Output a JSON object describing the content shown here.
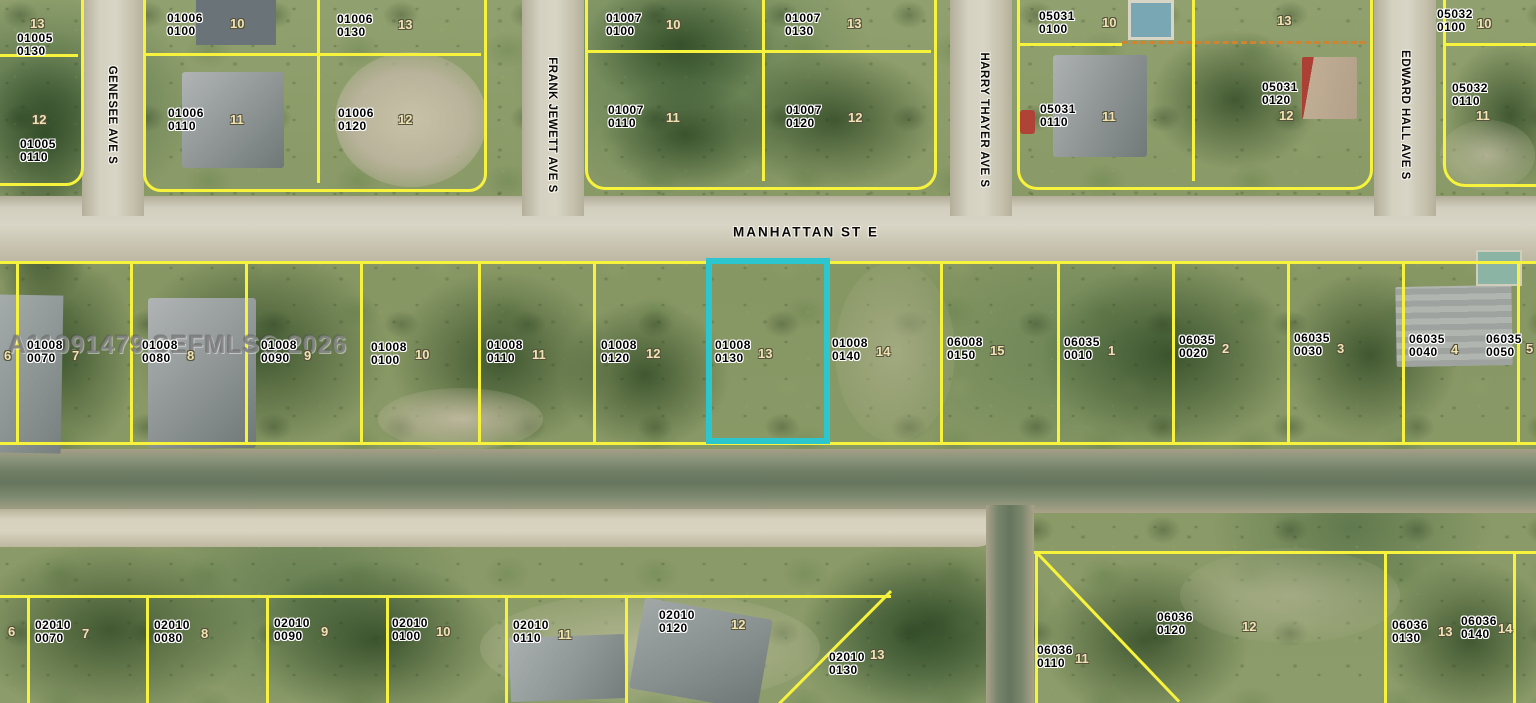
{
  "watermark": "A11091479 SEFMLS© 2026",
  "highlighted_parcel": {
    "book": "01008",
    "page": "0130",
    "lot": "13",
    "outline_color": "#2cc7ce"
  },
  "colors": {
    "parcel_line": "#f7f33d",
    "dashed_line": "#cd8531",
    "highlight": "#2cc7ce"
  },
  "streets": [
    {
      "name": "GENESEE AVE S",
      "orientation": "vertical",
      "x": 112,
      "y": 115
    },
    {
      "name": "FRANK JEWETT AVE S",
      "orientation": "vertical",
      "x": 552,
      "y": 125
    },
    {
      "name": "MANHATTAN ST E",
      "orientation": "horizontal",
      "x": 806,
      "y": 232
    },
    {
      "name": "HARRY THAYER AVE S",
      "orientation": "vertical",
      "x": 984,
      "y": 120
    },
    {
      "name": "EDWARD HALL AVE S",
      "orientation": "vertical",
      "x": 1405,
      "y": 115
    }
  ],
  "parcels": [
    {
      "book": "01005",
      "page": "0130",
      "lot": "13",
      "x": 17,
      "y": 32,
      "lx": 30,
      "ly": 16
    },
    {
      "book": "01005",
      "page": "0110",
      "lot": "12",
      "x": 20,
      "y": 138,
      "lx": 32,
      "ly": 112
    },
    {
      "book": "01006",
      "page": "0100",
      "lot": "10",
      "x": 167,
      "y": 12,
      "lx": 230,
      "ly": 16
    },
    {
      "book": "01006",
      "page": "0130",
      "lot": "13",
      "x": 337,
      "y": 13,
      "lx": 398,
      "ly": 17
    },
    {
      "book": "01006",
      "page": "0110",
      "lot": "11",
      "x": 168,
      "y": 107,
      "lx": 230,
      "ly": 112
    },
    {
      "book": "01006",
      "page": "0120",
      "lot": "12",
      "x": 338,
      "y": 107,
      "lx": 398,
      "ly": 112
    },
    {
      "book": "01007",
      "page": "0100",
      "lot": "10",
      "x": 606,
      "y": 12,
      "lx": 666,
      "ly": 17
    },
    {
      "book": "01007",
      "page": "0130",
      "lot": "13",
      "x": 785,
      "y": 12,
      "lx": 847,
      "ly": 16
    },
    {
      "book": "01007",
      "page": "0110",
      "lot": "11",
      "x": 608,
      "y": 104,
      "lx": 666,
      "ly": 110
    },
    {
      "book": "01007",
      "page": "0120",
      "lot": "12",
      "x": 786,
      "y": 104,
      "lx": 848,
      "ly": 110
    },
    {
      "book": "05031",
      "page": "0100",
      "lot": "10",
      "x": 1039,
      "y": 10,
      "lx": 1102,
      "ly": 15
    },
    {
      "lot": "13",
      "lx": 1277,
      "ly": 13
    },
    {
      "book": "05031",
      "page": "0120",
      "lot": "12",
      "x": 1262,
      "y": 81,
      "lx": 1279,
      "ly": 108
    },
    {
      "book": "05031",
      "page": "0110",
      "lot": "11",
      "x": 1040,
      "y": 103,
      "lx": 1102,
      "ly": 109
    },
    {
      "book": "05032",
      "page": "0100",
      "lot": "10",
      "x": 1437,
      "y": 8,
      "lx": 1477,
      "ly": 16
    },
    {
      "book": "05032",
      "page": "0110",
      "lot": "11",
      "x": 1452,
      "y": 82,
      "lx": 1476,
      "ly": 108
    },
    {
      "lot": "6",
      "lx": 4,
      "ly": 348
    },
    {
      "book": "01008",
      "page": "0070",
      "lot": "7",
      "x": 27,
      "y": 339,
      "lx": 72,
      "ly": 348
    },
    {
      "book": "01008",
      "page": "0080",
      "lot": "8",
      "x": 142,
      "y": 339,
      "lx": 187,
      "ly": 348
    },
    {
      "book": "01008",
      "page": "0090",
      "lot": "9",
      "x": 261,
      "y": 339,
      "lx": 304,
      "ly": 348
    },
    {
      "book": "01008",
      "page": "0100",
      "lot": "10",
      "x": 371,
      "y": 341,
      "lx": 415,
      "ly": 347
    },
    {
      "book": "01008",
      "page": "0110",
      "lot": "11",
      "x": 487,
      "y": 339,
      "lx": 532,
      "ly": 347
    },
    {
      "book": "01008",
      "page": "0120",
      "lot": "12",
      "x": 601,
      "y": 339,
      "lx": 646,
      "ly": 346
    },
    {
      "book": "01008",
      "page": "0130",
      "lot": "13",
      "x": 715,
      "y": 339,
      "lx": 758,
      "ly": 346
    },
    {
      "book": "01008",
      "page": "0140",
      "lot": "14",
      "x": 832,
      "y": 337,
      "lx": 876,
      "ly": 344
    },
    {
      "book": "06008",
      "page": "0150",
      "lot": "15",
      "x": 947,
      "y": 336,
      "lx": 990,
      "ly": 343
    },
    {
      "book": "06035",
      "page": "0010",
      "lot": "1",
      "x": 1064,
      "y": 336,
      "lx": 1108,
      "ly": 343
    },
    {
      "book": "06035",
      "page": "0020",
      "lot": "2",
      "x": 1179,
      "y": 334,
      "lx": 1222,
      "ly": 341
    },
    {
      "book": "06035",
      "page": "0030",
      "lot": "3",
      "x": 1294,
      "y": 332,
      "lx": 1337,
      "ly": 341
    },
    {
      "book": "06035",
      "page": "0040",
      "lot": "4",
      "x": 1409,
      "y": 333,
      "lx": 1451,
      "ly": 342
    },
    {
      "book": "06035",
      "page": "0050",
      "lot": "5",
      "x": 1486,
      "y": 333,
      "lx": 1526,
      "ly": 341
    },
    {
      "lot": "6",
      "lx": 8,
      "ly": 624
    },
    {
      "book": "02010",
      "page": "0070",
      "lot": "7",
      "x": 35,
      "y": 619,
      "lx": 82,
      "ly": 626
    },
    {
      "book": "02010",
      "page": "0080",
      "lot": "8",
      "x": 154,
      "y": 619,
      "lx": 201,
      "ly": 626
    },
    {
      "book": "02010",
      "page": "0090",
      "lot": "9",
      "x": 274,
      "y": 617,
      "lx": 321,
      "ly": 624
    },
    {
      "book": "02010",
      "page": "0100",
      "lot": "10",
      "x": 392,
      "y": 617,
      "lx": 436,
      "ly": 624
    },
    {
      "book": "02010",
      "page": "0110",
      "lot": "11",
      "x": 513,
      "y": 619,
      "lx": 558,
      "ly": 627
    },
    {
      "book": "02010",
      "page": "0120",
      "lot": "12",
      "x": 659,
      "y": 609,
      "lx": 731,
      "ly": 617
    },
    {
      "book": "02010",
      "page": "0130",
      "lot": "13",
      "x": 829,
      "y": 651,
      "lx": 870,
      "ly": 647
    },
    {
      "book": "06036",
      "page": "0110",
      "lot": "11",
      "x": 1037,
      "y": 644,
      "lx": 1075,
      "ly": 651
    },
    {
      "book": "06036",
      "page": "0120",
      "lot": "12",
      "x": 1157,
      "y": 611,
      "lx": 1242,
      "ly": 619
    },
    {
      "book": "06036",
      "page": "0130",
      "lot": "13",
      "x": 1392,
      "y": 619,
      "lx": 1438,
      "ly": 624
    },
    {
      "book": "06036",
      "page": "0140",
      "lot": "14",
      "x": 1461,
      "y": 615,
      "lx": 1498,
      "ly": 621
    }
  ]
}
